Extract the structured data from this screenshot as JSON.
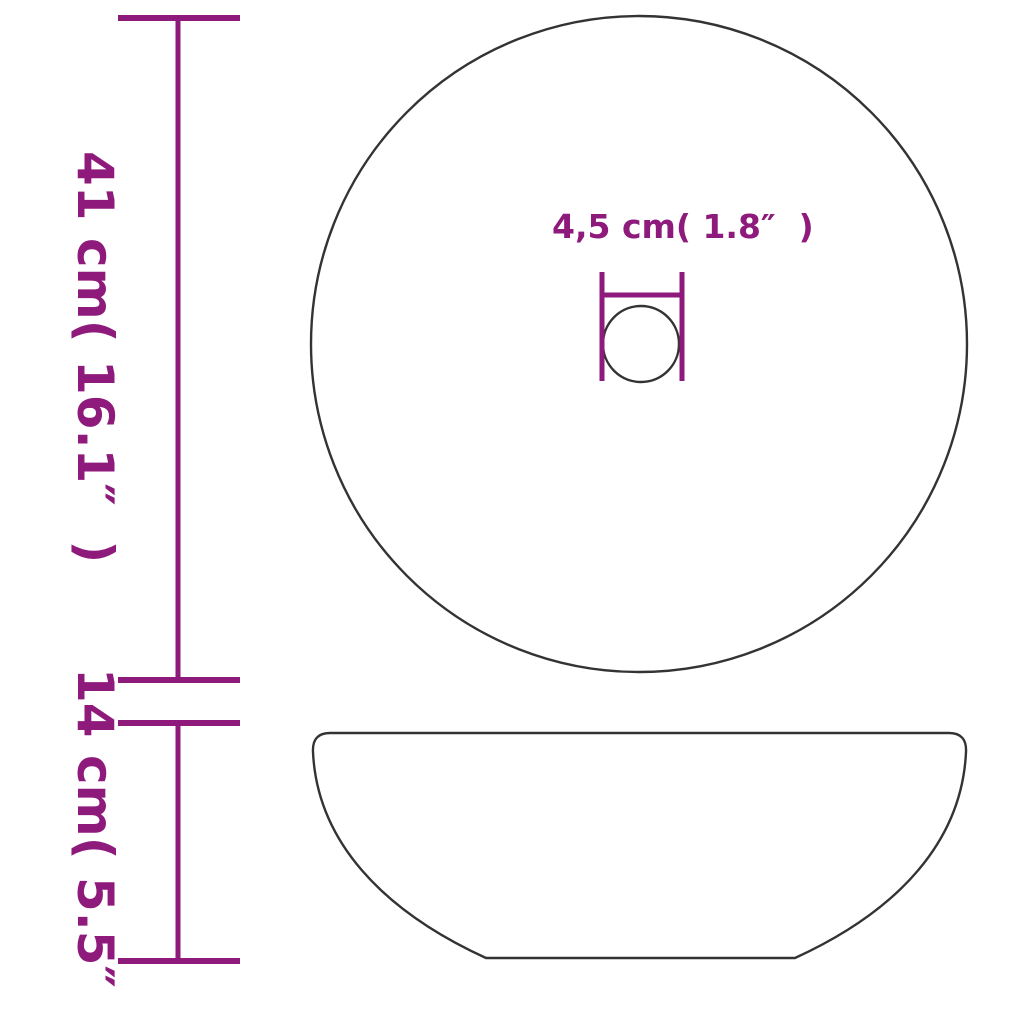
{
  "colors": {
    "dimension_lines": "#8E1A7C",
    "product_outline": "#333333",
    "background": "#FFFFFF"
  },
  "dimensions": {
    "diameter": {
      "label": "41 cm( 16.1″  )",
      "cm": "41",
      "inches": "16.1"
    },
    "height": {
      "label": "14 cm( 5.5″  )",
      "cm": "14",
      "inches": "5.5"
    },
    "drain_hole": {
      "label": "4,5 cm( 1.8″  )",
      "cm": "4,5",
      "inches": "1.8"
    }
  }
}
